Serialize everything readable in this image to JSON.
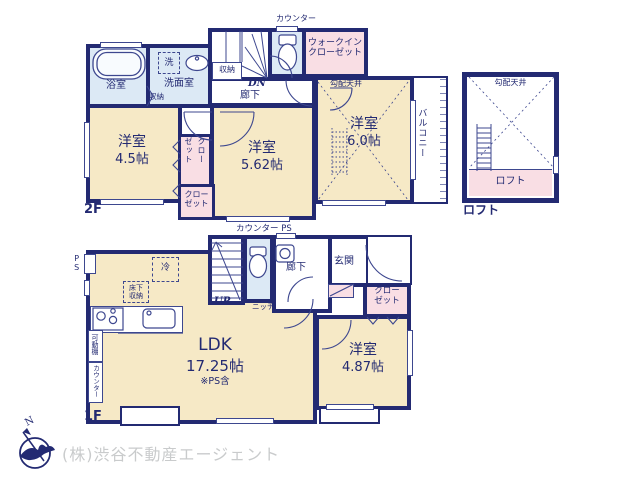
{
  "colors": {
    "wall": "#232a72",
    "line": "#3d478f",
    "ink": "#232a72",
    "cream": "#f6e9c6",
    "wet": "#dce9f5",
    "pink": "#f9dee4",
    "gray_text": "#c9cbcc"
  },
  "f2": {
    "floor_label": "2F",
    "counter": "カウンター",
    "stair_storage": "収納",
    "dn": "DN",
    "hallway": "廊下",
    "bath": "浴室",
    "washer": "洗",
    "washroom": "洗面室",
    "washroom_storage": "収納",
    "wic_line1": "ウォークイン",
    "wic_line2": "クローゼット",
    "sloped_ceiling": "勾配天井",
    "room_a_name": "洋室",
    "room_a_size": "4.5帖",
    "closet_v_col1": "クロー",
    "closet_v_col2": "ゼット",
    "closet_b_line1": "クロー",
    "closet_b_line2": "ゼット",
    "room_b_name": "洋室",
    "room_b_size": "5.62帖",
    "room_c_name": "洋室",
    "room_c_size": "6.0帖",
    "balcony": "バルコニー"
  },
  "loft": {
    "sloped_ceiling": "勾配天井",
    "area_label": "ロフト",
    "caption": "ロフト"
  },
  "f1": {
    "floor_label": "1F",
    "counter_ps": "カウンター PS",
    "up": "UP",
    "niche": "ニッチ",
    "hallway": "廊下",
    "entrance": "玄関",
    "ps": "PS",
    "fridge": "冷",
    "underfloor_line1": "床下",
    "underfloor_line2": "収納",
    "movable_shelf": "可動棚",
    "counter_vertical": "カウンター",
    "ldk_name": "LDK",
    "ldk_size": "17.25帖",
    "ldk_note": "※PS含",
    "room_d_name": "洋室",
    "room_d_size": "4.87帖",
    "closet_line1": "クロー",
    "closet_line2": "ゼット"
  },
  "footer": {
    "north": "N",
    "company": "(株)渋谷不動産エージェント"
  }
}
